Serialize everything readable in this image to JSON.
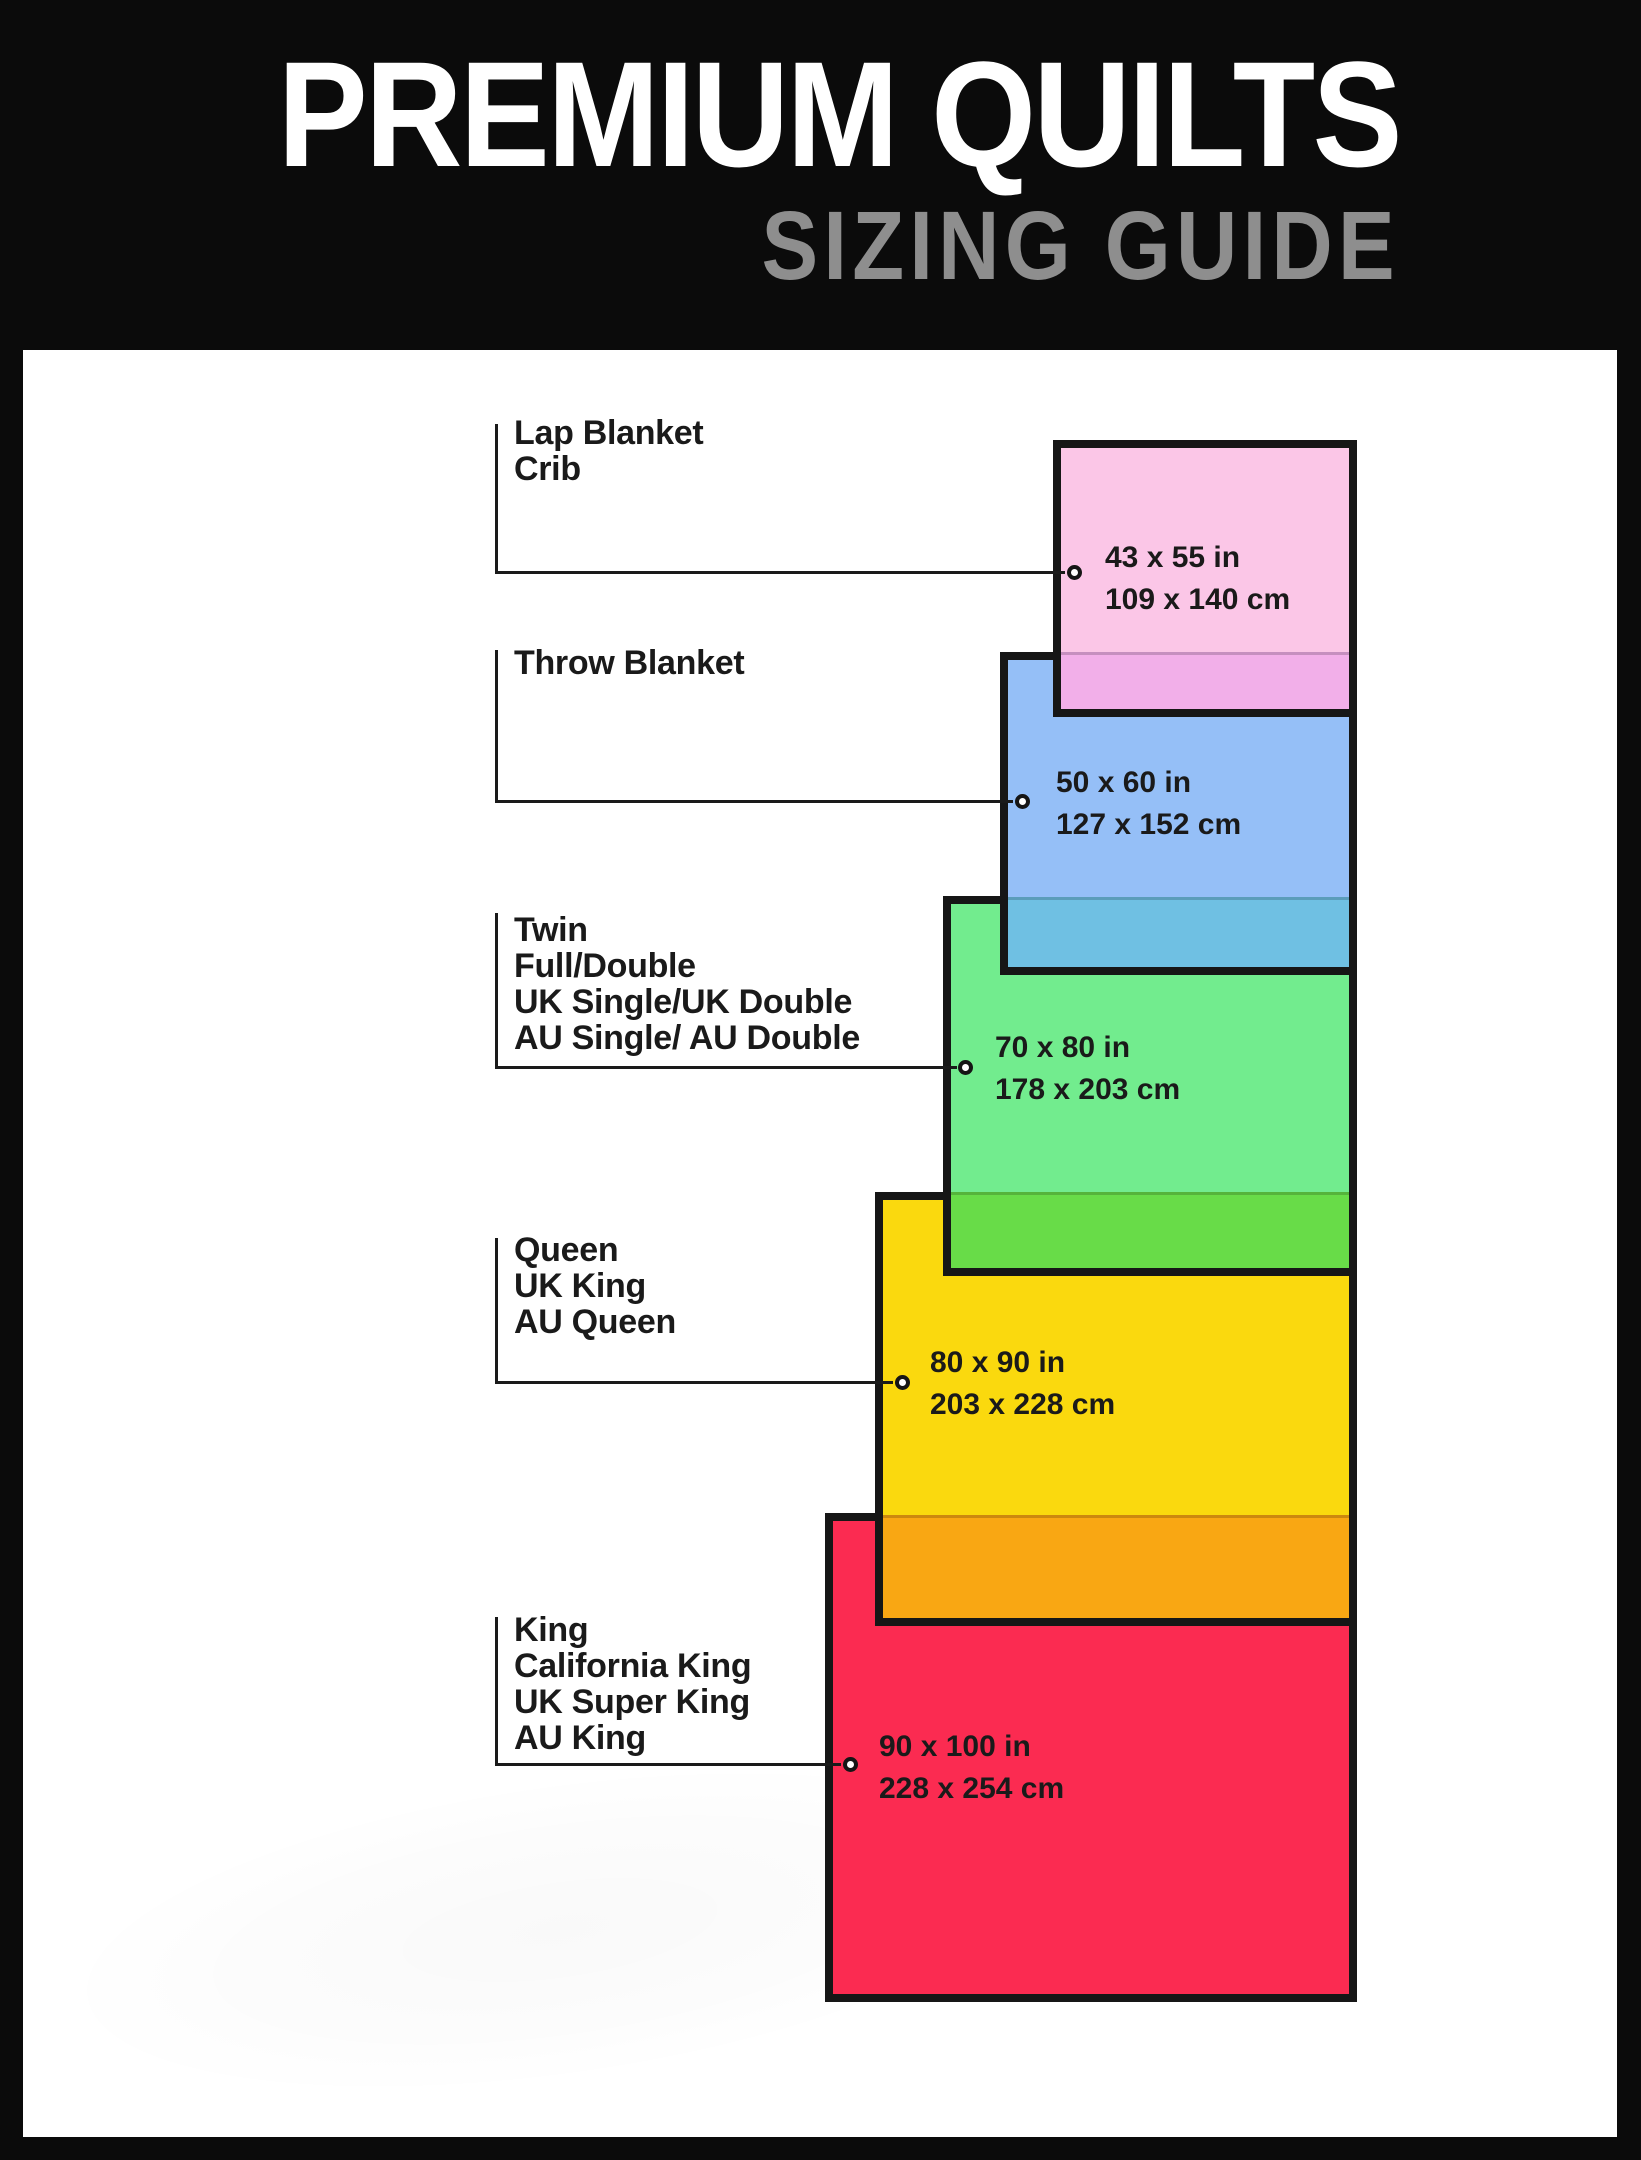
{
  "header": {
    "title": "PREMIUM QUILTS",
    "subtitle": "SIZING GUIDE",
    "background_color": "#0B0B0B",
    "title_color": "#FFFFFF",
    "subtitle_color": "#8E8E8E"
  },
  "canvas": {
    "background_color": "#FFFFFF",
    "border_color": "#161616",
    "ink_color": "#1A1A1A"
  },
  "sizes": [
    {
      "id": "lap-blanket-crib",
      "labels": [
        "Lap Blanket",
        "Crib"
      ],
      "inches": "43 x 55 in",
      "cm": "109 x 140 cm",
      "fill_color": "#FBC6E7",
      "overlap_fill_color": "#F2AFE9"
    },
    {
      "id": "throw-blanket",
      "labels": [
        "Throw Blanket"
      ],
      "inches": "50 x 60 in",
      "cm": "127 x 152 cm",
      "fill_color": "#95BFF7",
      "overlap_fill_color": "#6FC0E3"
    },
    {
      "id": "twin-full-double",
      "labels": [
        "Twin",
        "Full/Double",
        "UK Single/UK Double",
        "AU Single/ AU Double"
      ],
      "inches": "70 x 80 in",
      "cm": "178 x 203 cm",
      "fill_color": "#72EC8E",
      "overlap_fill_color": "#68DC48"
    },
    {
      "id": "queen",
      "labels": [
        "Queen",
        "UK King",
        "AU Queen"
      ],
      "inches": "80 x 90 in",
      "cm": "203 x 228 cm",
      "fill_color": "#FAD90E",
      "overlap_fill_color": "#F9A713"
    },
    {
      "id": "king",
      "labels": [
        "King",
        "California King",
        "UK Super King",
        "AU King"
      ],
      "inches": "90 x 100 in",
      "cm": "228 x 254 cm",
      "fill_color": "#FB2B51",
      "overlap_fill_color": null
    }
  ]
}
